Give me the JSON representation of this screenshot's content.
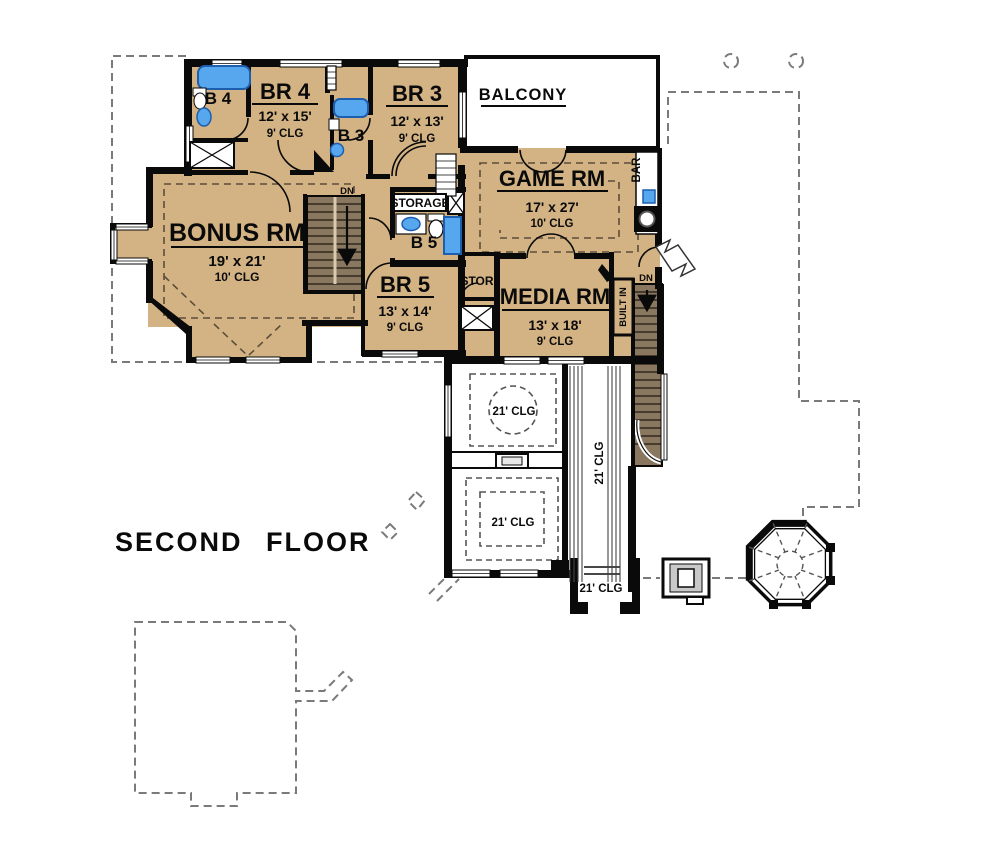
{
  "title": "SECOND FLOOR",
  "plan": {
    "rooms": {
      "br4": {
        "name": "BR 4",
        "dims": "12' x 15'",
        "clg": "9' CLG"
      },
      "br3": {
        "name": "BR 3",
        "dims": "12' x 13'",
        "clg": "9' CLG"
      },
      "br5": {
        "name": "BR 5",
        "dims": "13' x 14'",
        "clg": "9' CLG"
      },
      "game": {
        "name": "GAME RM",
        "dims": "17' x 27'",
        "clg": "10' CLG"
      },
      "bonus": {
        "name": "BONUS RM",
        "dims": "19' x 21'",
        "clg": "10' CLG"
      },
      "media": {
        "name": "MEDIA RM",
        "dims": "13' x 18'",
        "clg": "9' CLG"
      },
      "b4": "B 4",
      "b3": "B 3",
      "b5": "B 5",
      "balcony": "BALCONY",
      "storage": "STORAGE",
      "stor": "STOR",
      "bar": "BAR",
      "built_in": "BUILT IN"
    },
    "stairs": {
      "down_label": "DN"
    },
    "ceiling_note": "21' CLG",
    "colors": {
      "floor_tan": "#d3b384",
      "wall_black": "#0a0a0a",
      "stair_brown": "#8a7760",
      "fixture_blue": "#57a7ee",
      "roof_dash_gray": "#7a7a7a"
    }
  }
}
